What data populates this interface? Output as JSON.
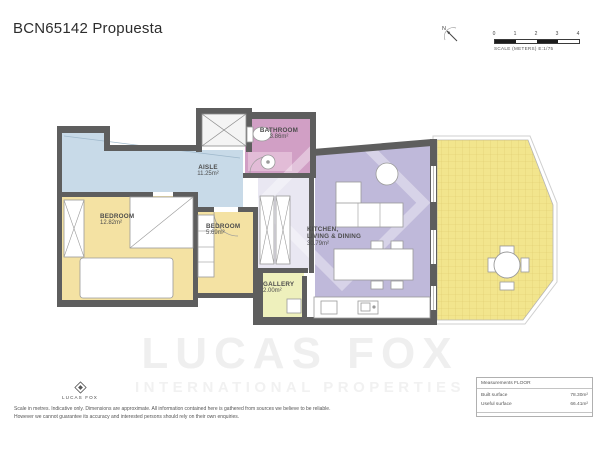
{
  "title": "BCN65142 Propuesta",
  "scale_bar": {
    "north_label": "N",
    "ticks": [
      "0",
      "1",
      "2",
      "3",
      "4"
    ],
    "caption": "SCALE (METERS) E:1/75"
  },
  "rooms": {
    "bathroom": {
      "name": "BATHROOM",
      "area": "3.86m²"
    },
    "aisle": {
      "name": "AISLE",
      "area": "11.25m²"
    },
    "bedroom1": {
      "name": "BEDROOM",
      "area": "12.82m²"
    },
    "bedroom2": {
      "name": "BEDROOM",
      "area": "5.69m²"
    },
    "kitchen": {
      "name_line1": "KITCHEN,",
      "name_line2": "LIVING & DINING",
      "area": "30.79m²"
    },
    "gallery": {
      "name": "GALLERY",
      "area": "2.00m²"
    }
  },
  "watermark": {
    "line1": "LUCAS FOX",
    "line2": "INTERNATIONAL PROPERTIES"
  },
  "footer": {
    "logo_text": "LUCAS FOX",
    "disclaimer_line1": "Scale in metres. Indicative only. Dimensions are approximate. All information contained here is gathered from sources we believe to be reliable.",
    "disclaimer_line2": "However we cannot guarantee its accuracy and interested persons should rely on their own enquiries."
  },
  "measurements": {
    "header": "Measurements FLOOR",
    "rows": [
      {
        "label": "Built surface",
        "value": "78.30m²"
      },
      {
        "label": "Useful surface",
        "value": "66.41m²"
      }
    ]
  },
  "colors": {
    "wall": "#5e5e5e",
    "bathroom_fill": "#d19fc5",
    "aisle_fill": "#c8dae8",
    "bedroom_fill": "#f4e2a3",
    "living_fill": "#bfb9da",
    "gallery_fill": "#eef0bc",
    "terrace_fill": "#f2e58d",
    "label_text": "#4d4d4d"
  }
}
